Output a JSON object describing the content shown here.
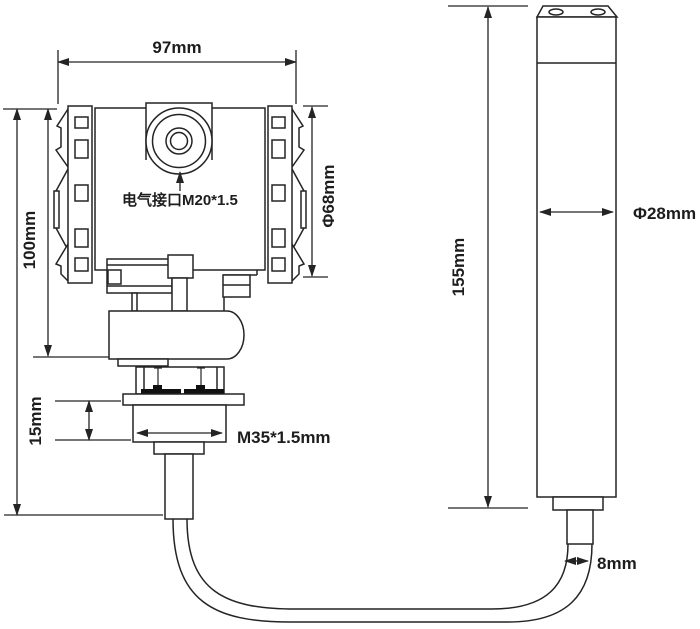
{
  "diagram": {
    "description": "Engineering dimension drawing of a pressure/level transmitter with separate submersible probe connected by a cable",
    "colors": {
      "background": "#ffffff",
      "line": "#242424",
      "bolt_fill": "#111111"
    },
    "labels": {
      "width_97": "97mm",
      "height_100": "100mm",
      "cover_dia_68": "Φ68mm",
      "electrical_interface": "电气接口M20*1.5",
      "thread_height_15": "15mm",
      "thread_spec_m35": "M35*1.5mm",
      "probe_length_155": "155mm",
      "probe_dia_28": "Φ28mm",
      "cable_dia_8": "8mm"
    }
  }
}
